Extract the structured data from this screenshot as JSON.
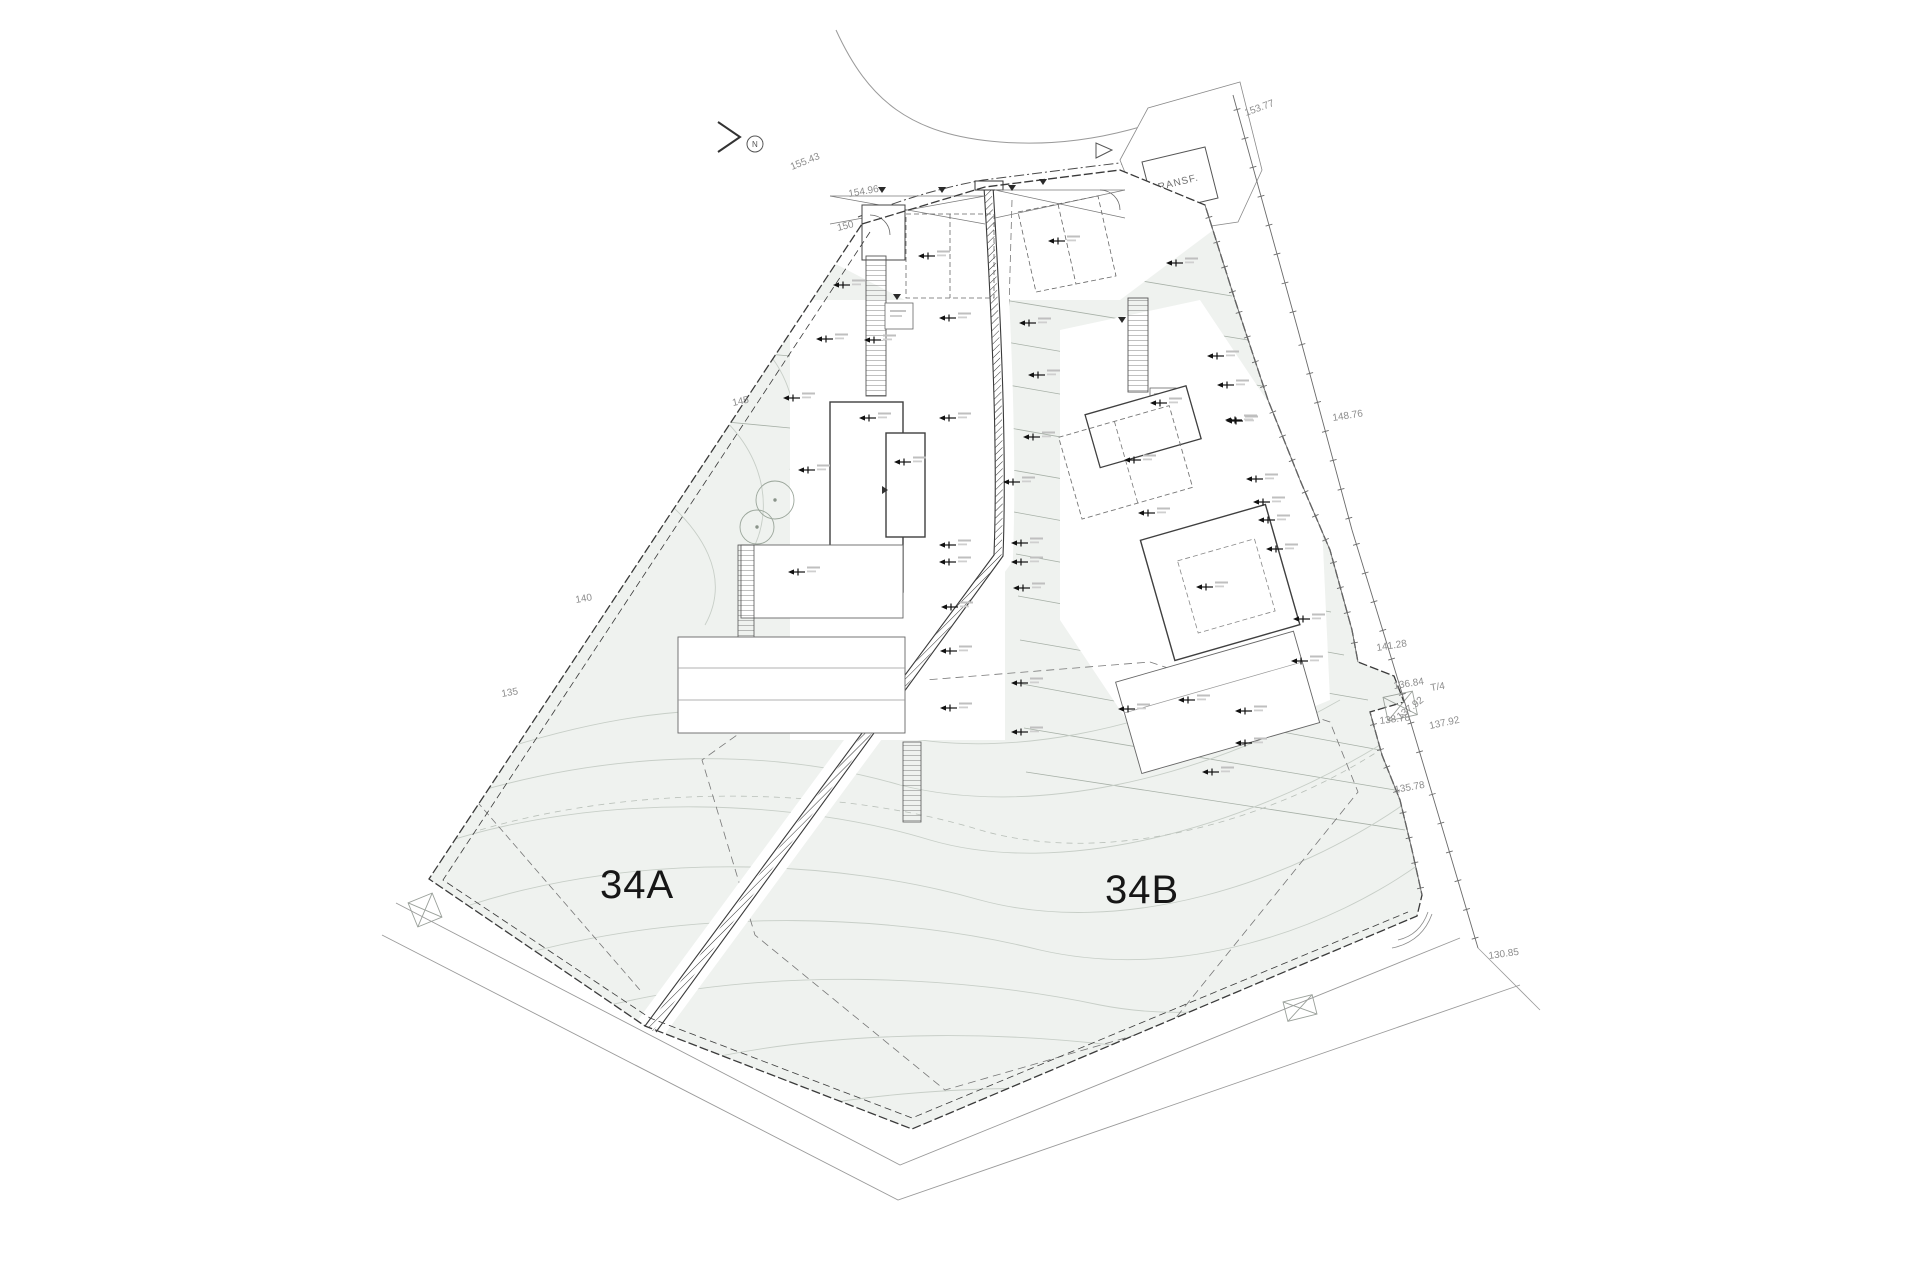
{
  "drawing": {
    "plot_a_label": "34A",
    "plot_b_label": "34B",
    "transformer_label": "TRANSF.",
    "north_label": "N"
  },
  "colors": {
    "parcel_fill": "#eff2ef",
    "boundary": "#3a3a3a",
    "building_stroke": "#444444",
    "terrace_line": "#a7b0a7",
    "contour": "#c7cec7",
    "dim_text": "#8d8d8d",
    "marker": "#111111"
  },
  "elevation_labels": [
    {
      "t": "155.43",
      "x": 792,
      "y": 170,
      "r": -22
    },
    {
      "t": "154.96",
      "x": 849,
      "y": 197,
      "r": -10
    },
    {
      "t": "150",
      "x": 838,
      "y": 231,
      "r": -14
    },
    {
      "t": "145",
      "x": 733,
      "y": 406,
      "r": -12
    },
    {
      "t": "140",
      "x": 576,
      "y": 603,
      "r": -10
    },
    {
      "t": "135",
      "x": 502,
      "y": 697,
      "r": -10
    },
    {
      "t": "153.77",
      "x": 1246,
      "y": 116,
      "r": -20
    },
    {
      "t": "148.76",
      "x": 1333,
      "y": 421,
      "r": -9
    },
    {
      "t": "141.28",
      "x": 1377,
      "y": 651,
      "r": -9
    },
    {
      "t": "136.84",
      "x": 1394,
      "y": 689,
      "r": -9
    },
    {
      "t": "T/4",
      "x": 1431,
      "y": 691,
      "r": -9
    },
    {
      "t": "138.78",
      "x": 1380,
      "y": 724,
      "r": -7
    },
    {
      "t": "137.92",
      "x": 1400,
      "y": 720,
      "r": -38
    },
    {
      "t": "137.92",
      "x": 1430,
      "y": 729,
      "r": -12
    },
    {
      "t": "135.78",
      "x": 1395,
      "y": 793,
      "r": -10
    },
    {
      "t": "130.85",
      "x": 1489,
      "y": 959,
      "r": -8
    }
  ],
  "spot_markers": [
    [
      840,
      285
    ],
    [
      823,
      339
    ],
    [
      871,
      340
    ],
    [
      946,
      318
    ],
    [
      1026,
      323
    ],
    [
      1035,
      375
    ],
    [
      925,
      256
    ],
    [
      1055,
      241
    ],
    [
      1173,
      263
    ],
    [
      790,
      398
    ],
    [
      866,
      418
    ],
    [
      946,
      418
    ],
    [
      1030,
      437
    ],
    [
      805,
      470
    ],
    [
      901,
      462
    ],
    [
      1010,
      482
    ],
    [
      946,
      545
    ],
    [
      1018,
      543
    ],
    [
      946,
      562
    ],
    [
      1018,
      562
    ],
    [
      795,
      572
    ],
    [
      1020,
      588
    ],
    [
      948,
      607
    ],
    [
      1018,
      683
    ],
    [
      947,
      708
    ],
    [
      1018,
      732
    ],
    [
      1125,
      709
    ],
    [
      1185,
      700
    ],
    [
      1242,
      711
    ],
    [
      1242,
      743
    ],
    [
      1157,
      403
    ],
    [
      1233,
      421
    ],
    [
      1131,
      460
    ],
    [
      1145,
      513
    ],
    [
      1253,
      479
    ],
    [
      1260,
      502
    ],
    [
      1265,
      520
    ],
    [
      1273,
      549
    ],
    [
      1203,
      587
    ],
    [
      1300,
      619
    ],
    [
      1298,
      661
    ],
    [
      1214,
      356
    ],
    [
      1224,
      385
    ],
    [
      1232,
      420
    ],
    [
      947,
      651
    ],
    [
      1209,
      772
    ]
  ],
  "bench_triangles": [
    [
      882,
      190
    ],
    [
      942,
      190
    ],
    [
      1012,
      188
    ],
    [
      1043,
      182
    ],
    [
      897,
      297
    ],
    [
      1122,
      320
    ]
  ],
  "door_arrows": [
    [
      882,
      490
    ]
  ],
  "tick_lines": [
    {
      "pts": [
        [
          1233,
          95
        ],
        [
          1298,
          330
        ],
        [
          1352,
          530
        ],
        [
          1398,
          680
        ],
        [
          1428,
          780
        ],
        [
          1478,
          948
        ]
      ],
      "s": 30
    },
    {
      "pts": [
        [
          1205,
          205
        ],
        [
          1235,
          300
        ],
        [
          1268,
          400
        ],
        [
          1300,
          480
        ],
        [
          1330,
          550
        ],
        [
          1352,
          630
        ],
        [
          1358,
          662
        ]
      ],
      "s": 26
    },
    {
      "pts": [
        [
          1370,
          712
        ],
        [
          1382,
          755
        ],
        [
          1400,
          800
        ],
        [
          1412,
          850
        ],
        [
          1422,
          895
        ]
      ],
      "s": 26
    }
  ]
}
